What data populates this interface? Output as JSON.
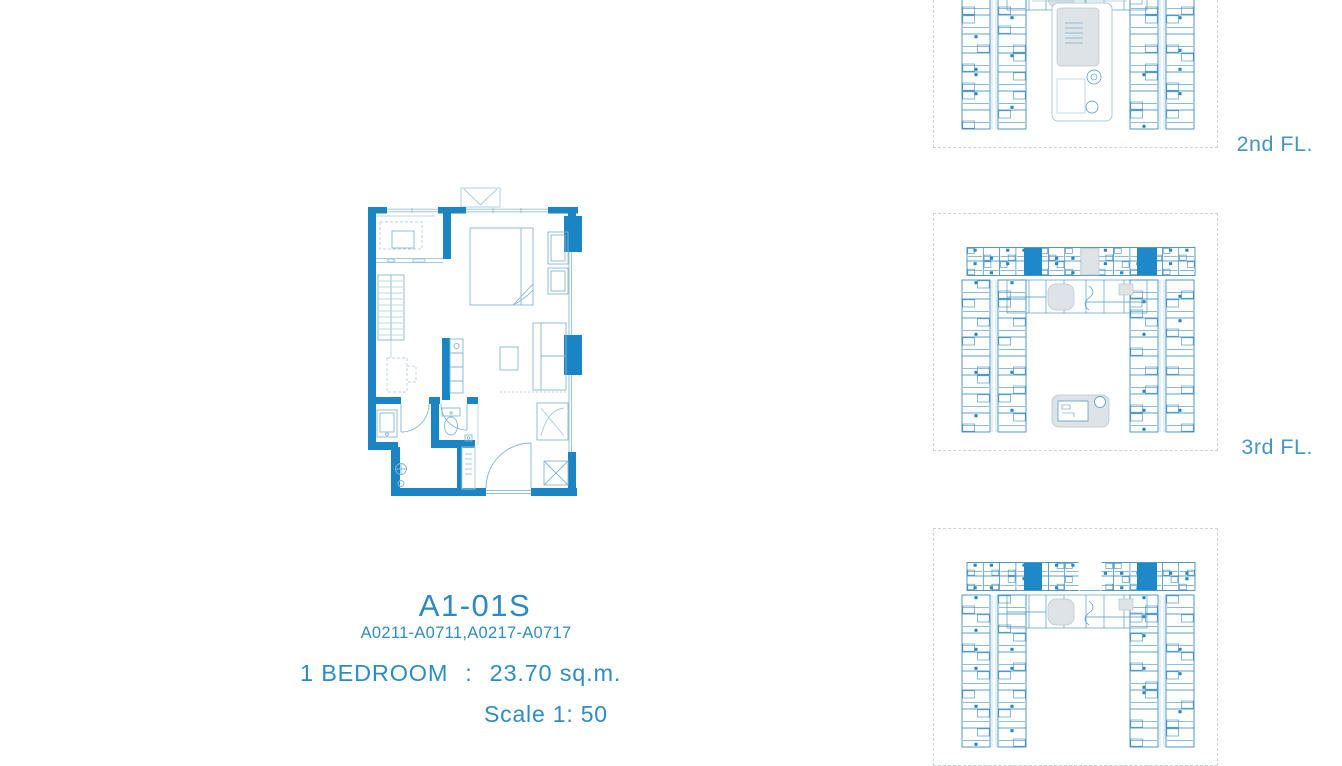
{
  "unit": {
    "code": "A1-01S",
    "unit_numbers": "A0211-A0711,A0217-A0717",
    "bedroom_label": "1 BEDROOM",
    "separator": ":",
    "area": "23.70 sq.m.",
    "scale": "Scale 1: 50"
  },
  "floors": [
    {
      "label": "2nd FL."
    },
    {
      "label": "3rd FL."
    },
    {
      "label": ""
    }
  ],
  "colors": {
    "wall_blue": "#1a85c2",
    "furniture_line": "#85b5d3",
    "window_line": "#90bcd6",
    "text_blue": "#2f8cc1",
    "floor_label_blue": "#4495c4",
    "keyplan_line": "#4a94c2",
    "highlight_unit": "#1f88c6",
    "amenity_gray": "#dde3e7",
    "dashed_border": "#c9d3da"
  }
}
